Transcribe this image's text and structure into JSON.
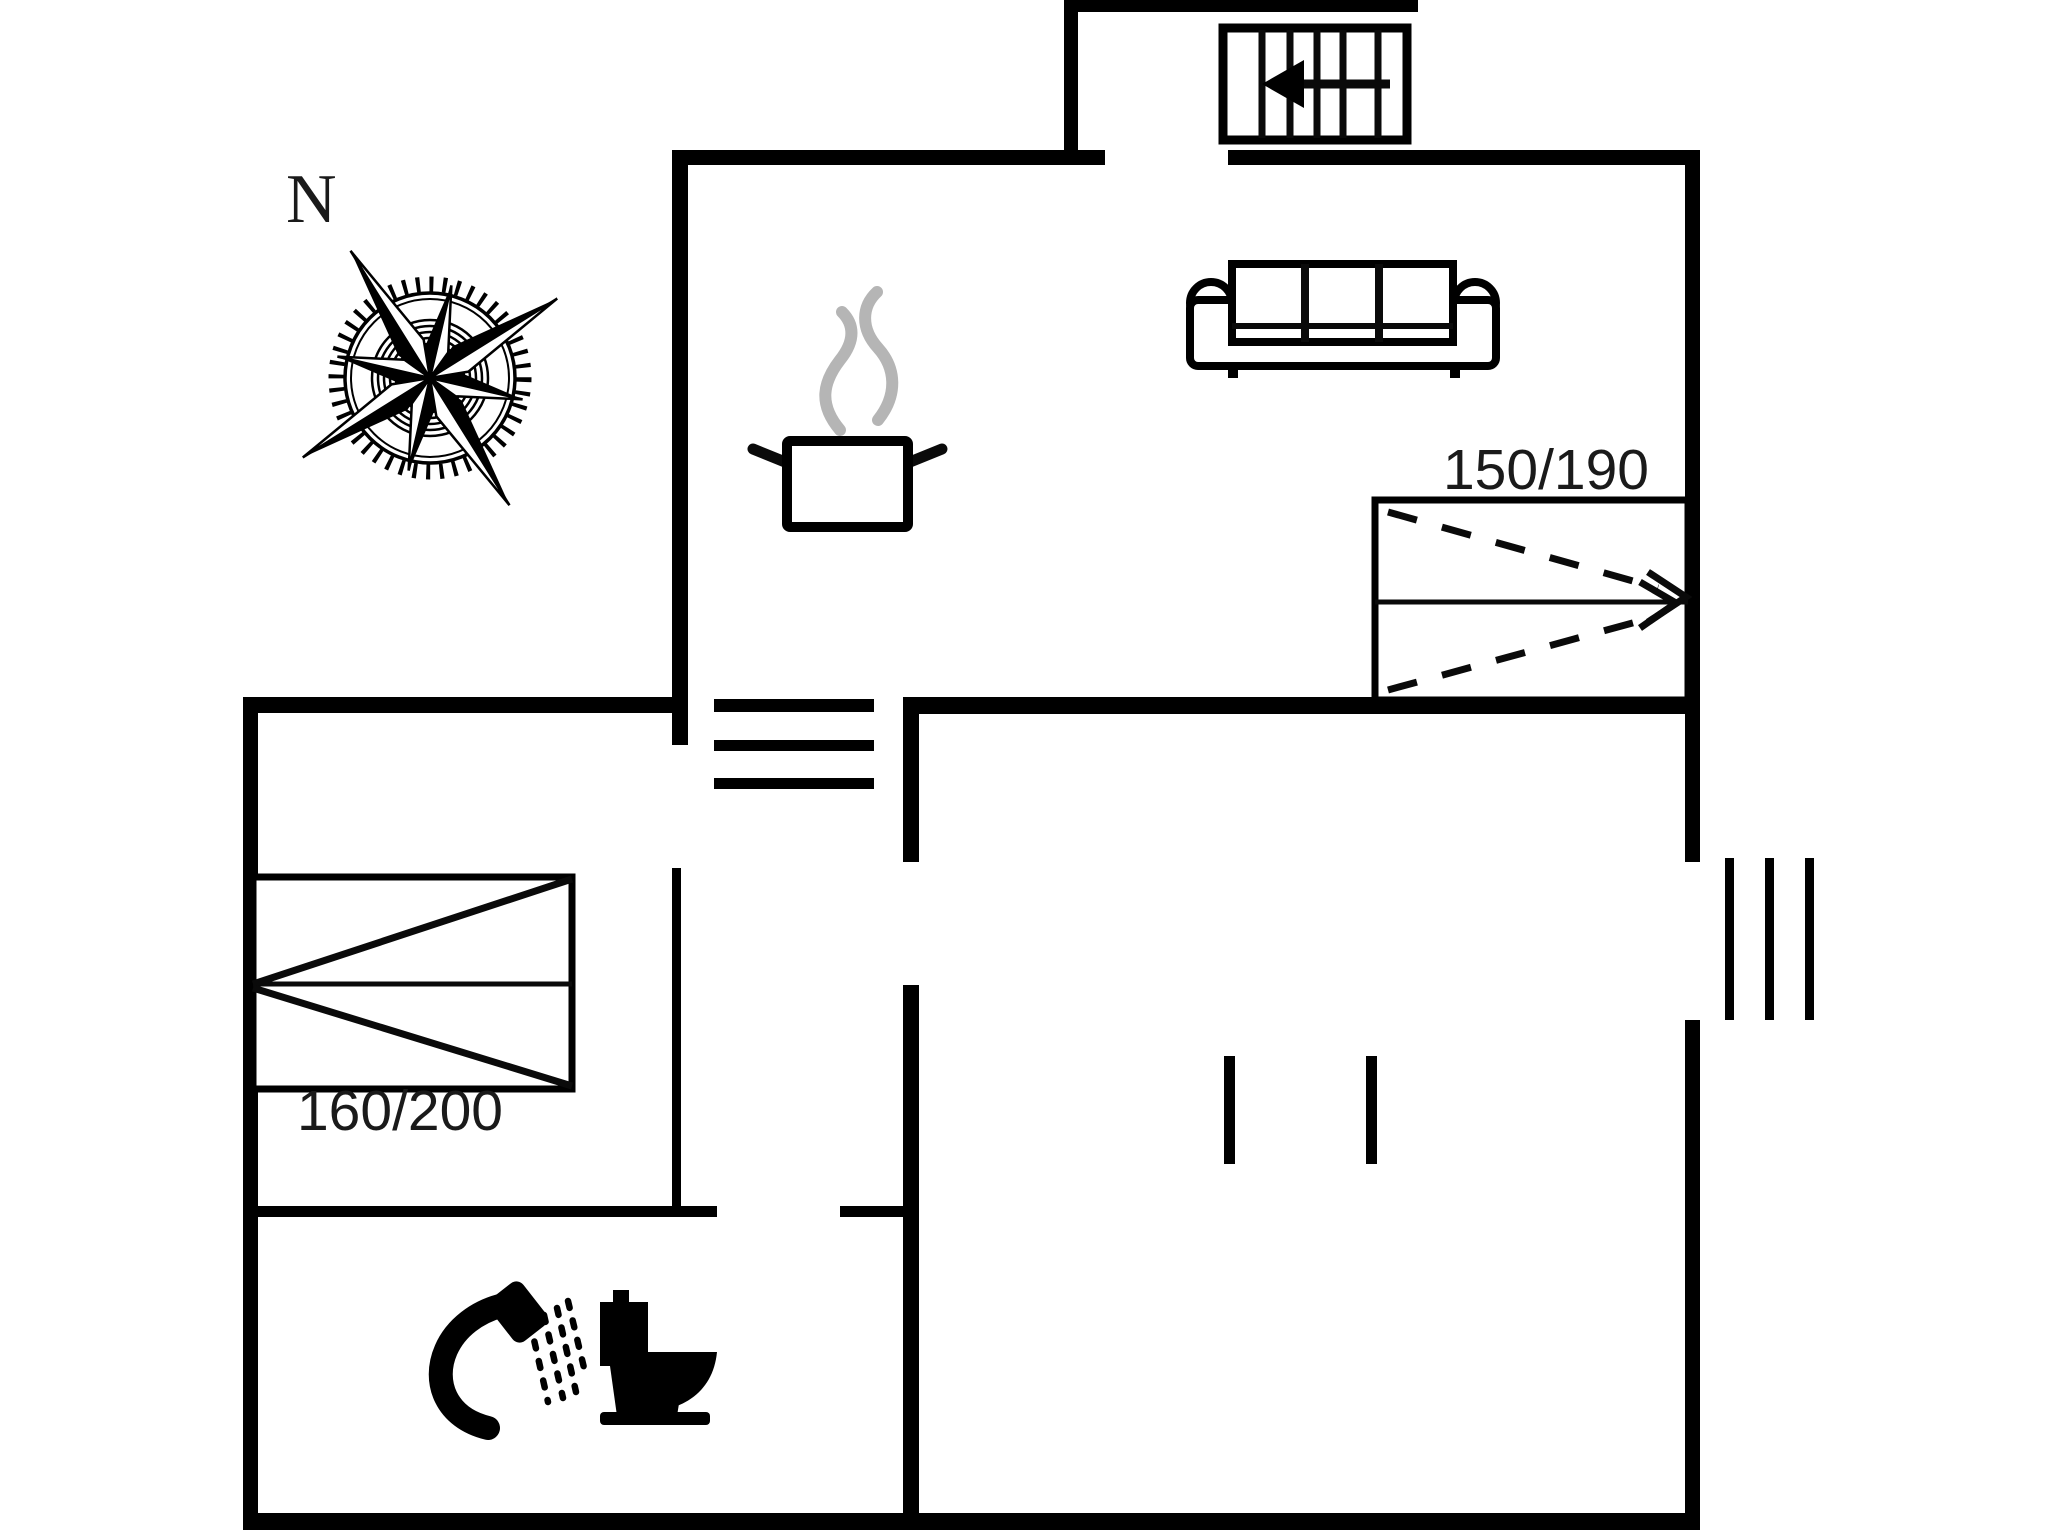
{
  "plan_type": "floorplan",
  "compass": {
    "north_label": "N",
    "icon": "compass-rose-icon"
  },
  "rooms": {
    "living_room": {
      "bed_size_label": "150/190",
      "icons": [
        "sofa-icon",
        "double-bed-icon"
      ]
    },
    "kitchen": {
      "icons": [
        "cooking-pot-icon",
        "steam-icon"
      ]
    },
    "bedroom": {
      "bed_size_label": "160/200",
      "icons": [
        "double-bed-icon"
      ]
    },
    "bathroom": {
      "icons": [
        "shower-icon",
        "toilet-icon"
      ]
    },
    "entrance": {
      "icons": [
        "staircase-icon",
        "arrow-left-icon"
      ]
    },
    "hallway": {
      "icons": [
        "steps-icon"
      ]
    }
  },
  "window": {
    "icon": "window-triple-line-icon"
  },
  "colors": {
    "wall": "#000000",
    "line": "#0a0a0a",
    "steam": "#b5b5b5",
    "background": "#ffffff",
    "text": "#1a1a1a"
  }
}
